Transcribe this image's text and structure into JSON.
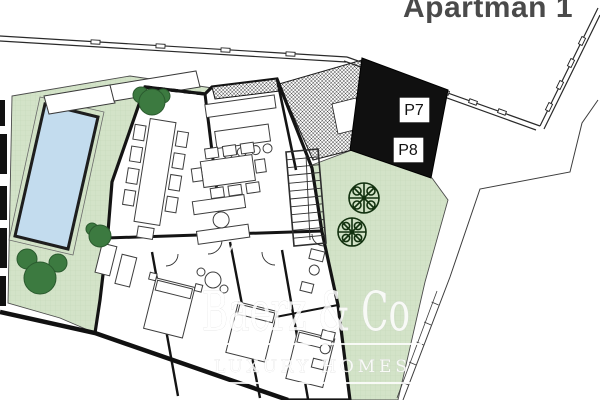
{
  "site_plan": {
    "apartment_label": "Apartman 1",
    "parking_spaces": [
      {
        "id": "P7"
      },
      {
        "id": "P8"
      }
    ],
    "watermark": {
      "brand": "Baerz & Co",
      "tagline": "LUXURY HOMES"
    },
    "colors": {
      "garden_green": "#d3e3c8",
      "garden_grid": "#c5d9ba",
      "pool_blue": "#c3dcee",
      "parking_black": "#101010",
      "wall_black": "#141414",
      "tree_green": "#3c7a40",
      "title_gray": "#4a4a4a",
      "watermark_white": "#ffffff"
    }
  }
}
